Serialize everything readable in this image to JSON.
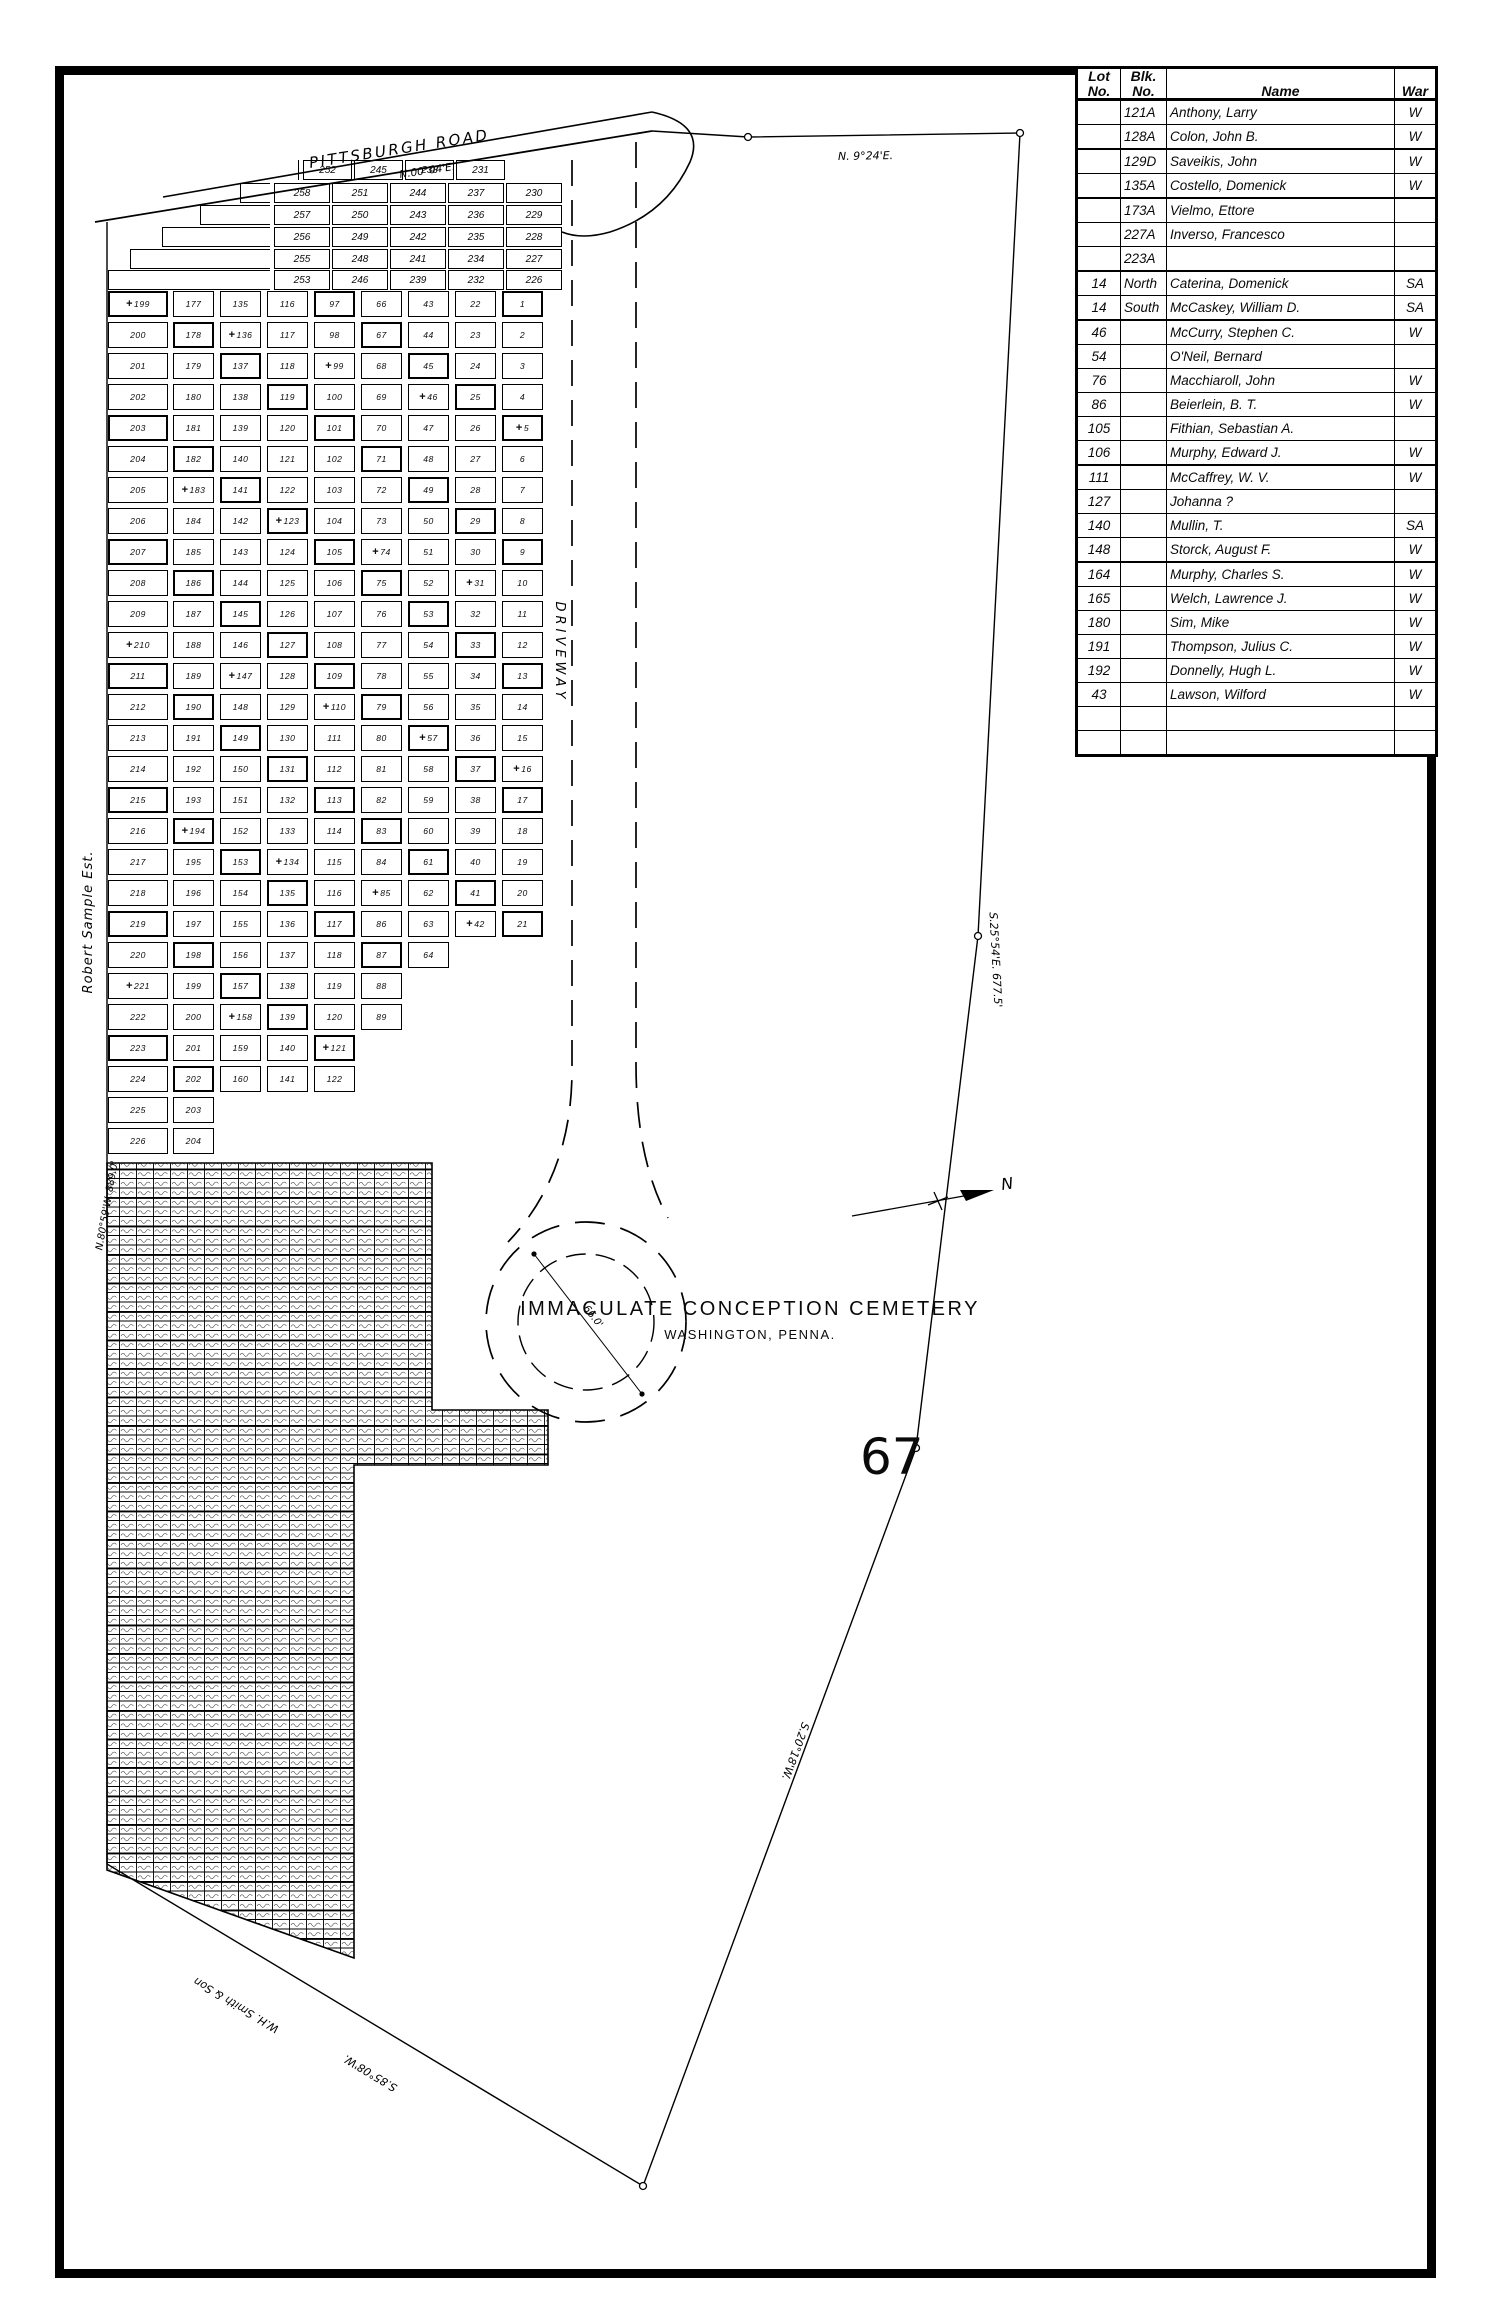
{
  "title": {
    "line1": "IMMACULATE CONCEPTION CEMETERY",
    "line2": "WASHINGTON, PENNA."
  },
  "page_number": "67",
  "table": {
    "col_headers": {
      "lot": "Lot\nNo.",
      "blk": "Blk.\nNo.",
      "name": "Name",
      "war": "War"
    },
    "heavy_rows": [
      1,
      3,
      6,
      8,
      14,
      18
    ],
    "rows": [
      {
        "lot": "",
        "blk": "121A",
        "name": "Anthony, Larry",
        "war": "W"
      },
      {
        "lot": "",
        "blk": "128A",
        "name": "Colon, John B.",
        "war": "W"
      },
      {
        "lot": "",
        "blk": "129D",
        "name": "Saveikis, John",
        "war": "W"
      },
      {
        "lot": "",
        "blk": "135A",
        "name": "Costello, Domenick",
        "war": "W"
      },
      {
        "lot": "",
        "blk": "173A",
        "name": "Vielmo, Ettore",
        "war": ""
      },
      {
        "lot": "",
        "blk": "227A",
        "name": "Inverso, Francesco",
        "war": ""
      },
      {
        "lot": "",
        "blk": "223A",
        "name": "",
        "war": ""
      },
      {
        "lot": "14",
        "blk": "North",
        "name": "Caterina, Domenick",
        "war": "SA"
      },
      {
        "lot": "14",
        "blk": "South",
        "name": "McCaskey, William D.",
        "war": "SA"
      },
      {
        "lot": "46",
        "blk": "",
        "name": "McCurry, Stephen C.",
        "war": "W"
      },
      {
        "lot": "54",
        "blk": "",
        "name": "O'Neil, Bernard",
        "war": ""
      },
      {
        "lot": "76",
        "blk": "",
        "name": "Macchiaroll, John",
        "war": "W"
      },
      {
        "lot": "86",
        "blk": "",
        "name": "Beierlein, B. T.",
        "war": "W"
      },
      {
        "lot": "105",
        "blk": "",
        "name": "Fithian, Sebastian A.",
        "war": ""
      },
      {
        "lot": "106",
        "blk": "",
        "name": "Murphy, Edward J.",
        "war": "W"
      },
      {
        "lot": "111",
        "blk": "",
        "name": "McCaffrey, W. V.",
        "war": "W"
      },
      {
        "lot": "127",
        "blk": "",
        "name": "Johanna ?",
        "war": ""
      },
      {
        "lot": "140",
        "blk": "",
        "name": "Mullin, T.",
        "war": "SA"
      },
      {
        "lot": "148",
        "blk": "",
        "name": "Storck, August F.",
        "war": "W"
      },
      {
        "lot": "164",
        "blk": "",
        "name": "Murphy, Charles S.",
        "war": "W"
      },
      {
        "lot": "165",
        "blk": "",
        "name": "Welch, Lawrence J.",
        "war": "W"
      },
      {
        "lot": "180",
        "blk": "",
        "name": "Sim, Mike",
        "war": "W"
      },
      {
        "lot": "191",
        "blk": "",
        "name": "Thompson, Julius C.",
        "war": "W"
      },
      {
        "lot": "192",
        "blk": "",
        "name": "Donnelly, Hugh L.",
        "war": "W"
      },
      {
        "lot": "43",
        "blk": "",
        "name": "Lawson, Wilford",
        "war": "W"
      },
      {
        "lot": "",
        "blk": "",
        "name": "",
        "war": ""
      },
      {
        "lot": "",
        "blk": "",
        "name": "",
        "war": ""
      }
    ]
  },
  "labels": {
    "road": "PITTSBURGH ROAD",
    "road_bearing": "N.00°04'E.",
    "top_bearing": "N. 9°24'E.",
    "east_bearing_upper": "S.25°54'E.  677.5'",
    "east_bearing_lower": "S.20°18'W.",
    "west_estate": "Robert Sample Est.",
    "west_bearing": "N.80°59'W. 889.0'",
    "bottom_owner": "W.H. Smith & Son",
    "bottom_bearing": "S.85°08'W.",
    "driveway": "DRIVEWAY",
    "circle_diameter": "66.0'",
    "north": "N"
  },
  "strips": [
    {
      "left": 298,
      "right": 505,
      "cells": [
        "252",
        "245",
        "238",
        "231"
      ]
    },
    {
      "left": 240,
      "right": 562,
      "cells": [
        "258",
        "251",
        "244",
        "237",
        "230"
      ]
    },
    {
      "left": 200,
      "right": 562,
      "cells": [
        "257",
        "250",
        "243",
        "236",
        "229"
      ]
    },
    {
      "left": 162,
      "right": 562,
      "cells": [
        "256",
        "249",
        "242",
        "235",
        "228"
      ]
    },
    {
      "left": 130,
      "right": 562,
      "cells": [
        "255",
        "248",
        "241",
        "234",
        "227"
      ]
    },
    {
      "left": 108,
      "right": 562,
      "cells": [
        "253",
        "246",
        "239",
        "232",
        "226"
      ]
    }
  ],
  "lot_grid": {
    "columns": [
      {
        "start": 199,
        "count": 28
      },
      {
        "start": 177,
        "count": 28
      },
      {
        "start": 135,
        "count": 26
      },
      {
        "start": 116,
        "count": 26
      },
      {
        "start": 97,
        "count": 26
      },
      {
        "start": 66,
        "count": 24
      },
      {
        "start": 43,
        "count": 22
      },
      {
        "start": 22,
        "count": 21
      },
      {
        "start": 1,
        "count": 21
      }
    ]
  }
}
